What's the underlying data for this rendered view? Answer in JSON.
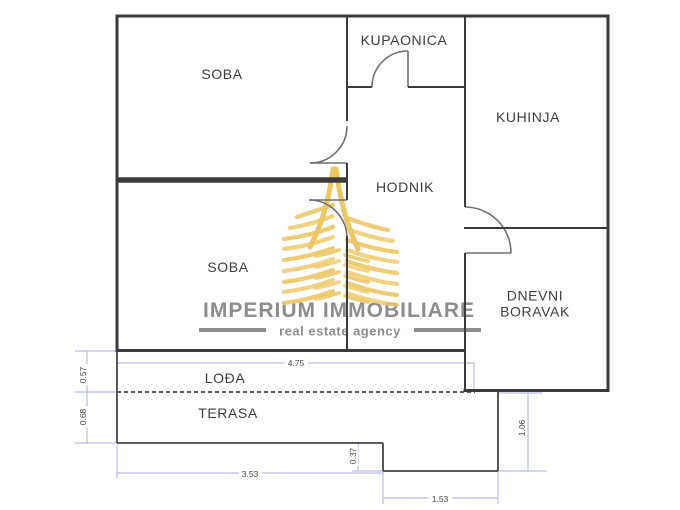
{
  "floorplan": {
    "rooms": [
      {
        "id": "soba-1",
        "label": "SOBA"
      },
      {
        "id": "kupaonica",
        "label": "KUPAONICA"
      },
      {
        "id": "kuhinja",
        "label": "KUHINJA"
      },
      {
        "id": "hodnik",
        "label": "HODNIK"
      },
      {
        "id": "soba-2",
        "label": "SOBA"
      },
      {
        "id": "dnevni-boravak",
        "label": "DNEVNI BORAVAK"
      },
      {
        "id": "lodja",
        "label": "LOĐA"
      },
      {
        "id": "terasa",
        "label": "TERASA"
      }
    ],
    "dimensions": [
      {
        "id": "lodja-width",
        "value": "4.75",
        "orientation": "horizontal"
      },
      {
        "id": "terasa-width",
        "value": "3.53",
        "orientation": "horizontal"
      },
      {
        "id": "step-width",
        "value": "1.53",
        "orientation": "horizontal"
      },
      {
        "id": "lodja-height",
        "value": "0.57",
        "orientation": "vertical"
      },
      {
        "id": "terasa-height",
        "value": "0.68",
        "orientation": "vertical"
      },
      {
        "id": "step-height",
        "value": "0.37",
        "orientation": "vertical"
      },
      {
        "id": "right-extension-height",
        "value": "1.06",
        "orientation": "vertical"
      }
    ],
    "colors": {
      "wall": "#3b3b3b",
      "door": "#707070",
      "terrace_line": "#454545",
      "dimension_line": "#b9bce9",
      "dimension_text": "#454545",
      "logo_gold": "#edc763",
      "logo_text": "#8d8d8d"
    }
  },
  "logo": {
    "name": "IMPERIUM IMMOBILIARE",
    "tagline": "real estate agency"
  }
}
